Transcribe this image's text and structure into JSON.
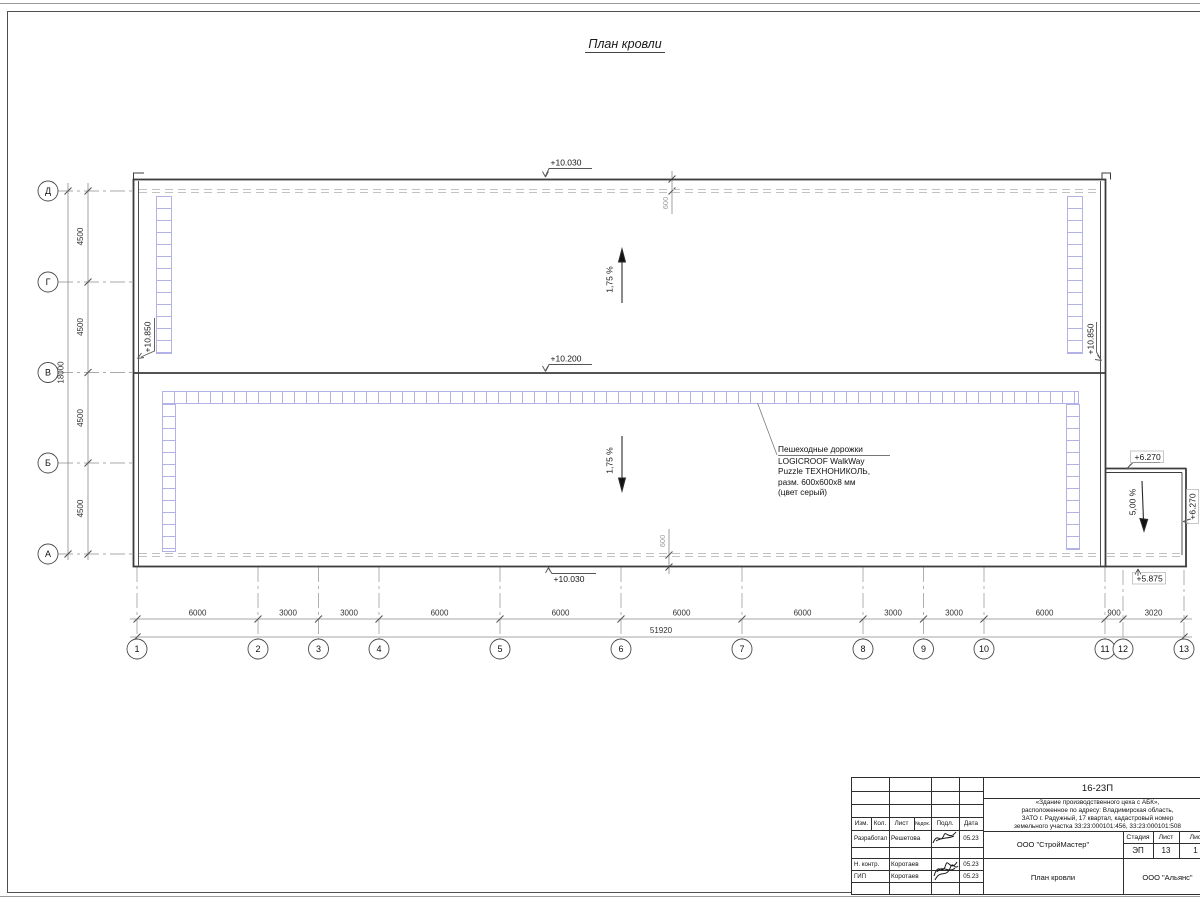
{
  "page": {
    "title": "План кровли"
  },
  "axes": {
    "rows": [
      "Д",
      "Г",
      "В",
      "Б",
      "А"
    ],
    "cols": [
      "1",
      "2",
      "3",
      "4",
      "5",
      "6",
      "7",
      "8",
      "9",
      "10",
      "11",
      "12",
      "13"
    ]
  },
  "dims": {
    "row_segments": [
      "4500",
      "4500",
      "4500",
      "4500"
    ],
    "row_total": "18000",
    "col_segments": [
      "6000",
      "3000",
      "3000",
      "6000",
      "6000",
      "6000",
      "6000",
      "3000",
      "3000",
      "6000",
      "900",
      "3020"
    ],
    "col_total": "51920",
    "edge_offset_top": "600",
    "edge_offset_bottom": "600"
  },
  "elevations": {
    "roof_top": "+10.030",
    "roof_mid": "+10.200",
    "roof_bottom": "+10.030",
    "parapet_left": "+10.850",
    "parapet_right": "+10.850",
    "annex_top": "+6.270",
    "annex_right": "+6.270",
    "annex_bottom": "+5.875"
  },
  "slopes": {
    "upper": "1,75 %",
    "lower": "1,75 %",
    "annex": "5,00 %"
  },
  "note": {
    "line1": "Пешеходные дорожки",
    "line2": "LOGICROOF WalkWay",
    "line3": "Puzzle ТЕХНОНИКОЛЬ,",
    "line4": "разм. 600х600х8 мм",
    "line5": "(цвет серый)"
  },
  "titleblock": {
    "doc_number": "16-23П",
    "description_lines": [
      "«Здание производственного цеха с АБК»,",
      "расположенное по адресу: Владимирская область,",
      "ЗАТО г. Радужный, 17 квартал, кадастровый номер",
      "земельного участка 33:23:000101:456, 33:23:000101:508"
    ],
    "header_cols": [
      "Изм.",
      "Кол.",
      "Лист",
      "№док.",
      "Подл.",
      "Дата"
    ],
    "rows": [
      {
        "role": "Разработал",
        "name": "Решетова",
        "date": "05.23"
      },
      {
        "role": "Н. контр.",
        "name": "Коротаев",
        "date": "05.23"
      },
      {
        "role": "ГИП",
        "name": "Коротаев",
        "date": "05.23"
      }
    ],
    "company": "ООО \"СтройМастер\"",
    "stage_cols": [
      "Стадия",
      "Лист",
      "Лис"
    ],
    "stage_values": [
      "ЭП",
      "13",
      "1"
    ],
    "sheet_name": "План кровли",
    "org": "ООО \"Альянс\""
  },
  "colors": {
    "walkway": "#b2b2e6",
    "line": "#3c3c3c",
    "dim": "#8a8a8a",
    "dashed_edge": "#c2c2c2"
  }
}
